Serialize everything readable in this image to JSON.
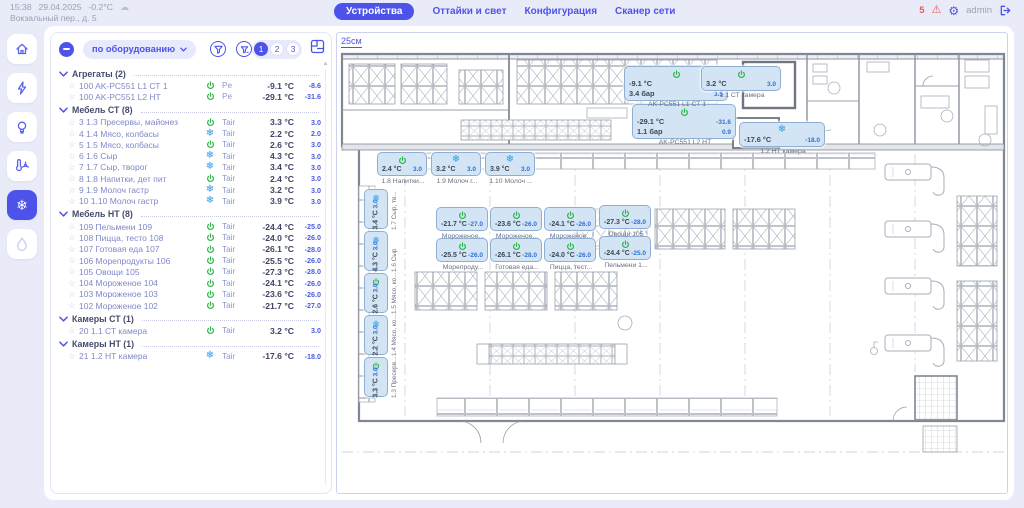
{
  "topbar": {
    "time": "15:38",
    "date": "29.04.2025",
    "outdoor_temp": "-0.2°C",
    "address": "Вокзальный пер., д. 5",
    "tabs": [
      {
        "id": "devices",
        "label": "Устройства",
        "active": true
      },
      {
        "id": "defrost-light",
        "label": "Оттайки и свет",
        "active": false
      },
      {
        "id": "configuration",
        "label": "Конфигурация",
        "active": false
      },
      {
        "id": "network-scanner",
        "label": "Сканер сети",
        "active": false
      }
    ],
    "alerts_count": "5",
    "user": "admin"
  },
  "sidebar": {
    "items": [
      {
        "icon": "home",
        "active": false
      },
      {
        "icon": "energy",
        "active": false
      },
      {
        "icon": "lighting",
        "active": false
      },
      {
        "icon": "climate",
        "active": false
      },
      {
        "icon": "refrigeration",
        "active": true
      },
      {
        "icon": "water",
        "active": false,
        "disabled": true
      }
    ]
  },
  "panel": {
    "dropdown_label": "по оборудованию",
    "pages": [
      "1",
      "2",
      "3"
    ],
    "active_page": "1",
    "sections": [
      {
        "title": "Агрегаты (2)",
        "rows": [
          {
            "name": "100 AK-PC551 L1 СТ 1",
            "icon": "power",
            "param": "Pe",
            "value": "-9.1 °C",
            "set": "-8.6"
          },
          {
            "name": "100 AK-PC551 L2 НТ",
            "icon": "power",
            "param": "Pe",
            "value": "-29.1 °C",
            "set": "-31.6"
          }
        ]
      },
      {
        "title": "Мебель СТ (8)",
        "rows": [
          {
            "name": "3 1.3 Пресервы, майонез",
            "icon": "power",
            "param": "Tair",
            "value": "3.3 °C",
            "set": "3.0"
          },
          {
            "name": "4 1.4 Мясо, колбасы",
            "icon": "defrost",
            "param": "Tair",
            "value": "2.2 °C",
            "set": "2.0"
          },
          {
            "name": "5 1.5 Мясо, колбасы",
            "icon": "power",
            "param": "Tair",
            "value": "2.6 °C",
            "set": "3.0"
          },
          {
            "name": "6 1.6 Сыр",
            "icon": "defrost",
            "param": "Tair",
            "value": "4.3 °C",
            "set": "3.0"
          },
          {
            "name": "7 1.7 Сыр, творог",
            "icon": "defrost",
            "param": "Tair",
            "value": "3.4 °C",
            "set": "3.0"
          },
          {
            "name": "8 1.8 Напитки, дет пит",
            "icon": "power",
            "param": "Tair",
            "value": "2.4 °C",
            "set": "3.0"
          },
          {
            "name": "9 1.9 Молоч гастр",
            "icon": "defrost",
            "param": "Tair",
            "value": "3.2 °C",
            "set": "3.0"
          },
          {
            "name": "10 1.10 Молоч гастр",
            "icon": "defrost",
            "param": "Tair",
            "value": "3.9 °C",
            "set": "3.0"
          }
        ]
      },
      {
        "title": "Мебель НТ (8)",
        "rows": [
          {
            "name": "109 Пельмени 109",
            "icon": "power",
            "param": "Tair",
            "value": "-24.4 °C",
            "set": "-25.0"
          },
          {
            "name": "108 Пицца, тесто 108",
            "icon": "power",
            "param": "Tair",
            "value": "-24.0 °C",
            "set": "-26.0"
          },
          {
            "name": "107 Готовая еда 107",
            "icon": "power",
            "param": "Tair",
            "value": "-26.1 °C",
            "set": "-28.0"
          },
          {
            "name": "106 Морепродукты 106",
            "icon": "power",
            "param": "Tair",
            "value": "-25.5 °C",
            "set": "-26.0"
          },
          {
            "name": "105 Овощи 105",
            "icon": "power",
            "param": "Tair",
            "value": "-27.3 °C",
            "set": "-28.0"
          },
          {
            "name": "104 Мороженое 104",
            "icon": "power",
            "param": "Tair",
            "value": "-24.1 °C",
            "set": "-26.0"
          },
          {
            "name": "103 Мороженое 103",
            "icon": "power",
            "param": "Tair",
            "value": "-23.6 °C",
            "set": "-26.0"
          },
          {
            "name": "102 Мороженое 102",
            "icon": "power",
            "param": "Tair",
            "value": "-21.7 °C",
            "set": "-27.0"
          }
        ]
      },
      {
        "title": "Камеры СТ (1)",
        "rows": [
          {
            "name": "20 1.1 СТ камера",
            "icon": "power",
            "param": "Tair",
            "value": "3.2 °C",
            "set": "3.0"
          }
        ]
      },
      {
        "title": "Камеры НТ (1)",
        "rows": [
          {
            "name": "21 1.2 НТ камера",
            "icon": "defrost",
            "param": "Tair",
            "value": "-17.6 °C",
            "set": "-18.0"
          }
        ]
      }
    ]
  },
  "plan": {
    "scale_label": "25см",
    "cards": [
      {
        "type": "big",
        "icon": "power",
        "x": 287,
        "y": 20,
        "w": 104,
        "rows": [
          [
            "-9.1 °C",
            "-8.6"
          ],
          [
            "3.4 бар",
            "3.5"
          ]
        ],
        "label": "AK-PC551 L1 СТ 1"
      },
      {
        "type": "big",
        "icon": "power",
        "x": 364,
        "y": 20,
        "w": 80,
        "rows": [
          [
            "3.2 °C",
            "3.0"
          ]
        ],
        "label": "1.1 СТ камера"
      },
      {
        "type": "big",
        "icon": "power",
        "x": 295,
        "y": 58,
        "w": 104,
        "rows": [
          [
            "-29.1 °C",
            "-31.6"
          ],
          [
            "1.1 бар",
            "0.9"
          ]
        ],
        "label": "AK-PC551 L2 НТ"
      },
      {
        "type": "big",
        "icon": "defrost",
        "x": 402,
        "y": 76,
        "w": 86,
        "rows": [
          [
            "-17.6 °C",
            "-18.0"
          ]
        ],
        "label": "1.2 НТ камера"
      },
      {
        "type": "h",
        "icon": "power",
        "x": 40,
        "y": 106,
        "w": 50,
        "rows": [
          [
            "2.4 °C",
            "3.0"
          ]
        ],
        "label": "1.8 Напитки..."
      },
      {
        "type": "h",
        "icon": "defrost",
        "x": 94,
        "y": 106,
        "w": 50,
        "rows": [
          [
            "3.2 °C",
            "3.0"
          ]
        ],
        "label": "1.9 Молоч г..."
      },
      {
        "type": "h",
        "icon": "defrost",
        "x": 148,
        "y": 106,
        "w": 50,
        "rows": [
          [
            "3.9 °C",
            "3.0"
          ]
        ],
        "label": "1.10 Молоч ..."
      },
      {
        "type": "v",
        "icon": "defrost",
        "x": 27,
        "y": 143,
        "rows": [
          [
            "3.4 °C",
            "3.0"
          ]
        ],
        "label": "1.7 Сыр, тв..."
      },
      {
        "type": "v",
        "icon": "defrost",
        "x": 27,
        "y": 185,
        "rows": [
          [
            "4.3 °C",
            "3.0"
          ]
        ],
        "label": "1.6 Сыр"
      },
      {
        "type": "v",
        "icon": "power",
        "x": 27,
        "y": 227,
        "rows": [
          [
            "2.6 °C",
            "3.0"
          ]
        ],
        "label": "1.5 Мясо, ко..."
      },
      {
        "type": "v",
        "icon": "defrost",
        "x": 27,
        "y": 269,
        "rows": [
          [
            "2.2 °C",
            "3.0"
          ]
        ],
        "label": "1.4 Мясо, ко..."
      },
      {
        "type": "v",
        "icon": "power",
        "x": 27,
        "y": 311,
        "rows": [
          [
            "3.3 °C",
            "3.0"
          ]
        ],
        "label": "1.3 Пресерв..."
      },
      {
        "type": "h",
        "icon": "power",
        "x": 99,
        "y": 161,
        "w": 52,
        "rows": [
          [
            "-21.7 °C",
            "-27.0"
          ]
        ],
        "label": "Мороженое..."
      },
      {
        "type": "h",
        "icon": "power",
        "x": 153,
        "y": 161,
        "w": 52,
        "rows": [
          [
            "-23.6 °C",
            "-26.0"
          ]
        ],
        "label": "Мороженое..."
      },
      {
        "type": "h",
        "icon": "power",
        "x": 207,
        "y": 161,
        "w": 52,
        "rows": [
          [
            "-24.1 °C",
            "-26.0"
          ]
        ],
        "label": "Мороженое..."
      },
      {
        "type": "h",
        "icon": "power",
        "x": 262,
        "y": 159,
        "w": 52,
        "rows": [
          [
            "-27.3 °C",
            "-28.0"
          ]
        ],
        "label": "Овощи 105"
      },
      {
        "type": "h",
        "icon": "power",
        "x": 99,
        "y": 192,
        "w": 52,
        "rows": [
          [
            "-25.5 °C",
            "-26.0"
          ]
        ],
        "label": "Морепроду..."
      },
      {
        "type": "h",
        "icon": "power",
        "x": 153,
        "y": 192,
        "w": 52,
        "rows": [
          [
            "-26.1 °C",
            "-28.0"
          ]
        ],
        "label": "Готовая еда..."
      },
      {
        "type": "h",
        "icon": "power",
        "x": 207,
        "y": 192,
        "w": 52,
        "rows": [
          [
            "-24.0 °C",
            "-26.0"
          ]
        ],
        "label": "Пицца, тест..."
      },
      {
        "type": "h",
        "icon": "power",
        "x": 262,
        "y": 190,
        "w": 52,
        "rows": [
          [
            "-24.4 °C",
            "-25.0"
          ]
        ],
        "label": "Пельмени 1..."
      }
    ]
  }
}
